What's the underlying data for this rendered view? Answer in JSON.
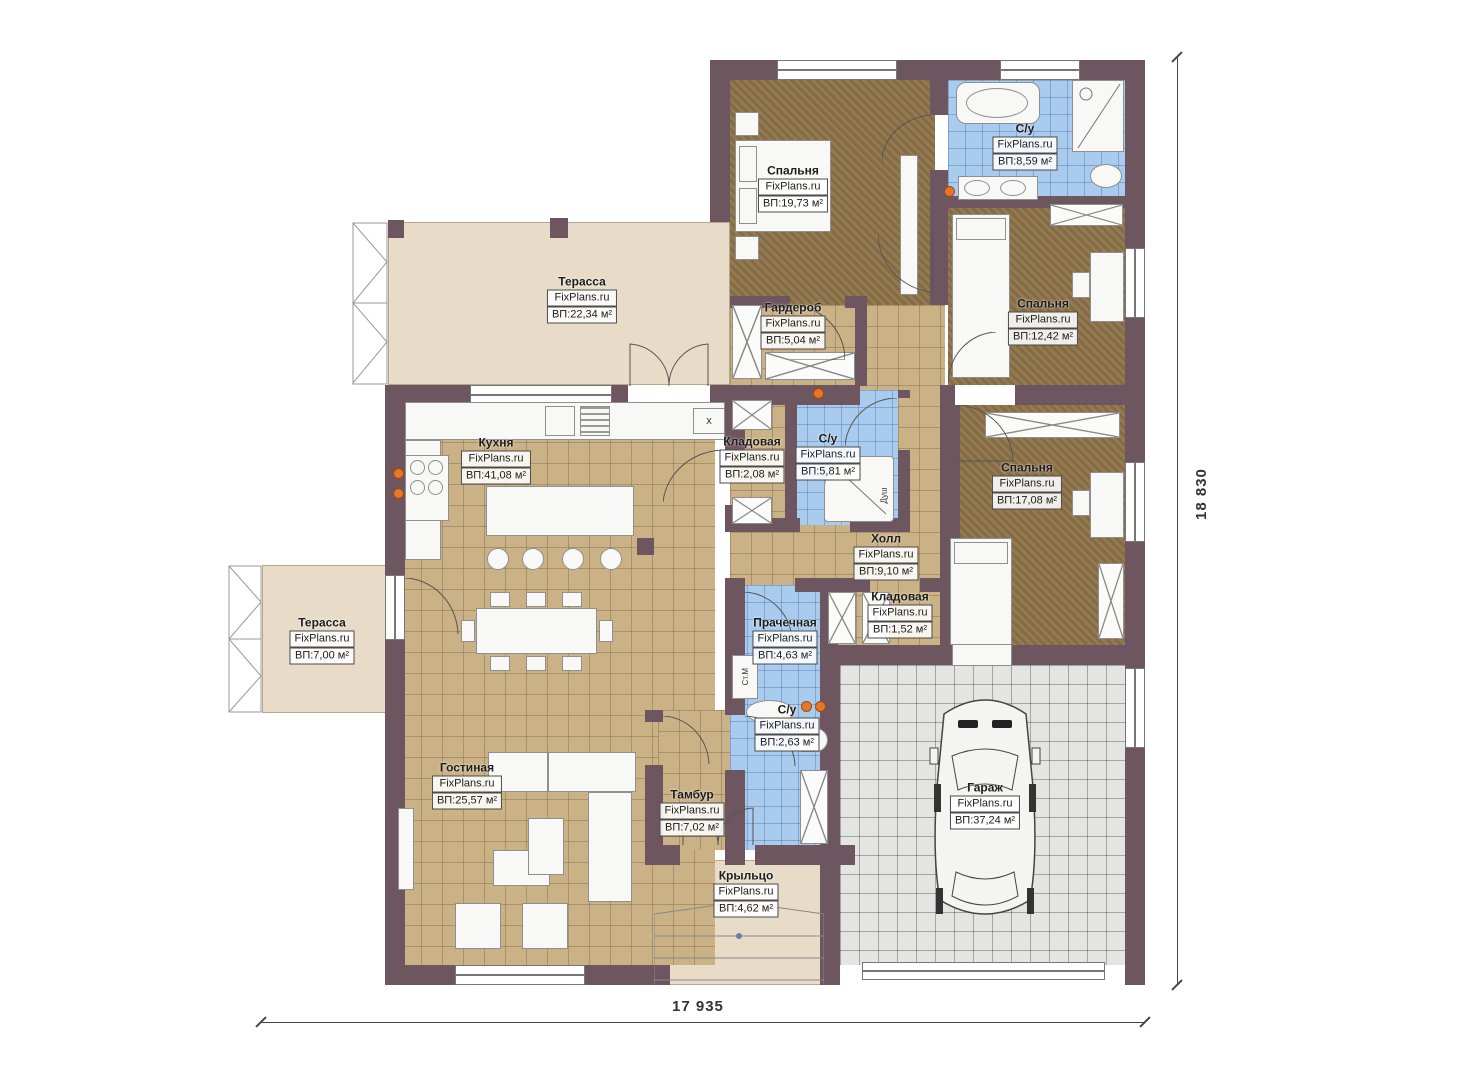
{
  "plan": {
    "watermark": "FixPlans.ru",
    "dimensions": {
      "width_label": "17 935",
      "height_label": "18 830"
    },
    "rooms": [
      {
        "id": "terrace-top",
        "name": "Терасса",
        "area": "ВП:22,34 м²"
      },
      {
        "id": "bedroom-1",
        "name": "Спальня",
        "area": "ВП:19,73 м²"
      },
      {
        "id": "bath-main",
        "name": "С/у",
        "area": "ВП:8,59 м²"
      },
      {
        "id": "wardrobe",
        "name": "Гардероб",
        "area": "ВП:5,04 м²"
      },
      {
        "id": "bedroom-2",
        "name": "Спальня",
        "area": "ВП:12,42 м²"
      },
      {
        "id": "kitchen",
        "name": "Кухня",
        "area": "ВП:41,08 м²"
      },
      {
        "id": "pantry-1",
        "name": "Кладовая",
        "area": "ВП:2,08 м²"
      },
      {
        "id": "bath-2",
        "name": "С/у",
        "area": "ВП:5,81 м²"
      },
      {
        "id": "bedroom-3",
        "name": "Спальня",
        "area": "ВП:17,08 м²"
      },
      {
        "id": "hall",
        "name": "Холл",
        "area": "ВП:9,10 м²"
      },
      {
        "id": "terrace-left",
        "name": "Терасса",
        "area": "ВП:7,00 м²"
      },
      {
        "id": "laundry",
        "name": "Прачечная",
        "area": "ВП:4,63 м²"
      },
      {
        "id": "pantry-2",
        "name": "Кладовая",
        "area": "ВП:1,52 м²"
      },
      {
        "id": "bath-3",
        "name": "С/у",
        "area": "ВП:2,63 м²"
      },
      {
        "id": "living",
        "name": "Гостиная",
        "area": "ВП:25,57 м²"
      },
      {
        "id": "tambour",
        "name": "Тамбур",
        "area": "ВП:7,02 м²"
      },
      {
        "id": "porch",
        "name": "Крыльцо",
        "area": "ВП:4,62 м²"
      },
      {
        "id": "garage",
        "name": "Гараж",
        "area": "ВП:37,24 м²"
      }
    ],
    "appliances": {
      "washing_machine": "Ст.М",
      "shower": "Душ",
      "hood": "x"
    },
    "colors": {
      "wall": "#6e5660",
      "floor_tan": "#cbb286",
      "floor_brown": "#8d7248",
      "floor_blue": "#a9cbee",
      "floor_gray": "#e4e4e2",
      "deck": "#e8dcc8",
      "marker": "#e8762a"
    }
  }
}
